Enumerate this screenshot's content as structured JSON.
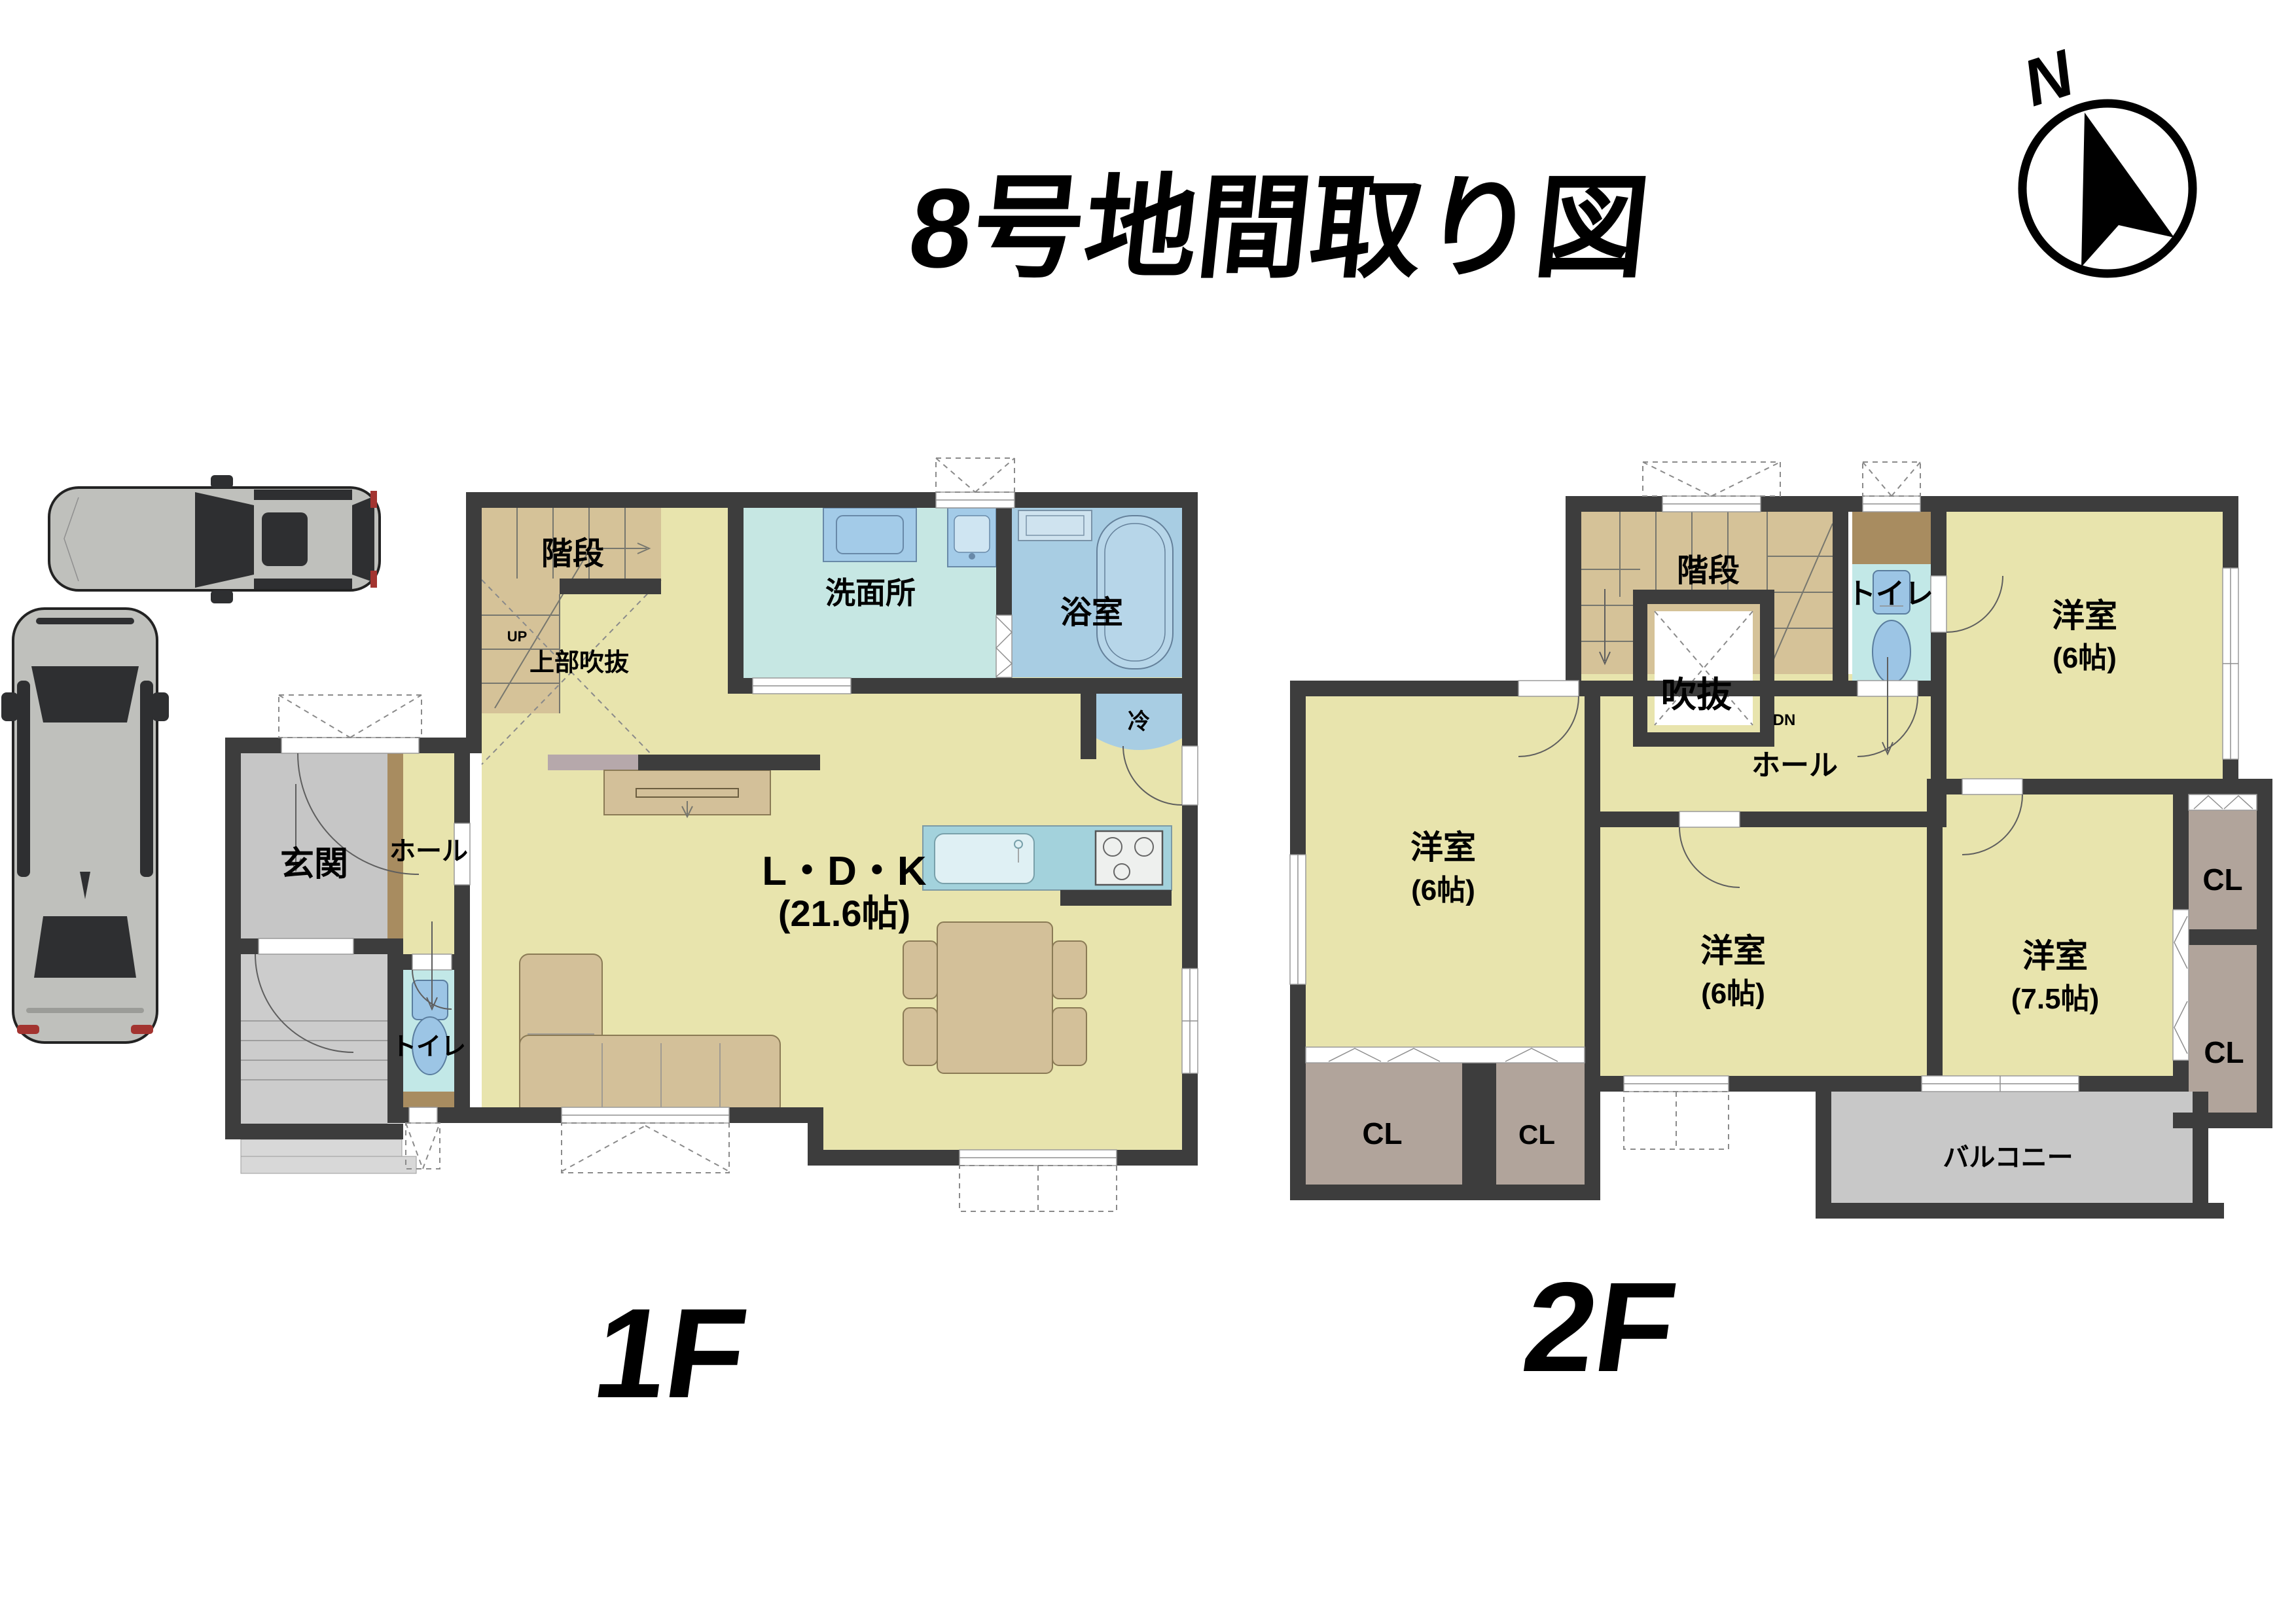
{
  "title": "8号地間取り図",
  "compass": {
    "north": "N"
  },
  "colors": {
    "wall": "#3d3d3d",
    "floor_yellow": "#e8e4ad",
    "stairs_tan": "#d5c298",
    "wet_cyan": "#c6e7e3",
    "bath_blue": "#a8cde3",
    "toilet_cyan": "#c2e8e7",
    "entry_gray": "#c6c6c6",
    "closet_mauve": "#b1a49b",
    "balcony_gray": "#c8c8c8",
    "wood_brown": "#a88c60",
    "counter_blue": "#a3d2dc"
  },
  "f1": {
    "floor_label": "1F",
    "stairs": "階段",
    "up": "UP",
    "void_above": "上部吹抜",
    "washroom": "洗面所",
    "bath": "浴室",
    "fridge": "冷",
    "ldk": "L・D・K",
    "ldk_size": "(21.6帖)",
    "genkan": "玄関",
    "hall": "ホール",
    "toilet": "トイレ"
  },
  "f2": {
    "floor_label": "2F",
    "stairs": "階段",
    "void": "吹抜",
    "down": "DN",
    "toilet": "トイレ",
    "hall": "ホール",
    "bedroom_ne": "洋室",
    "bedroom_ne_size": "(6帖)",
    "bedroom_w": "洋室",
    "bedroom_w_size": "(6帖)",
    "bedroom_s": "洋室",
    "bedroom_s_size": "(6帖)",
    "bedroom_se": "洋室",
    "bedroom_se_size": "(7.5帖)",
    "closets": [
      "CL",
      "CL",
      "CL",
      "CL"
    ],
    "balcony": "バルコニー"
  }
}
